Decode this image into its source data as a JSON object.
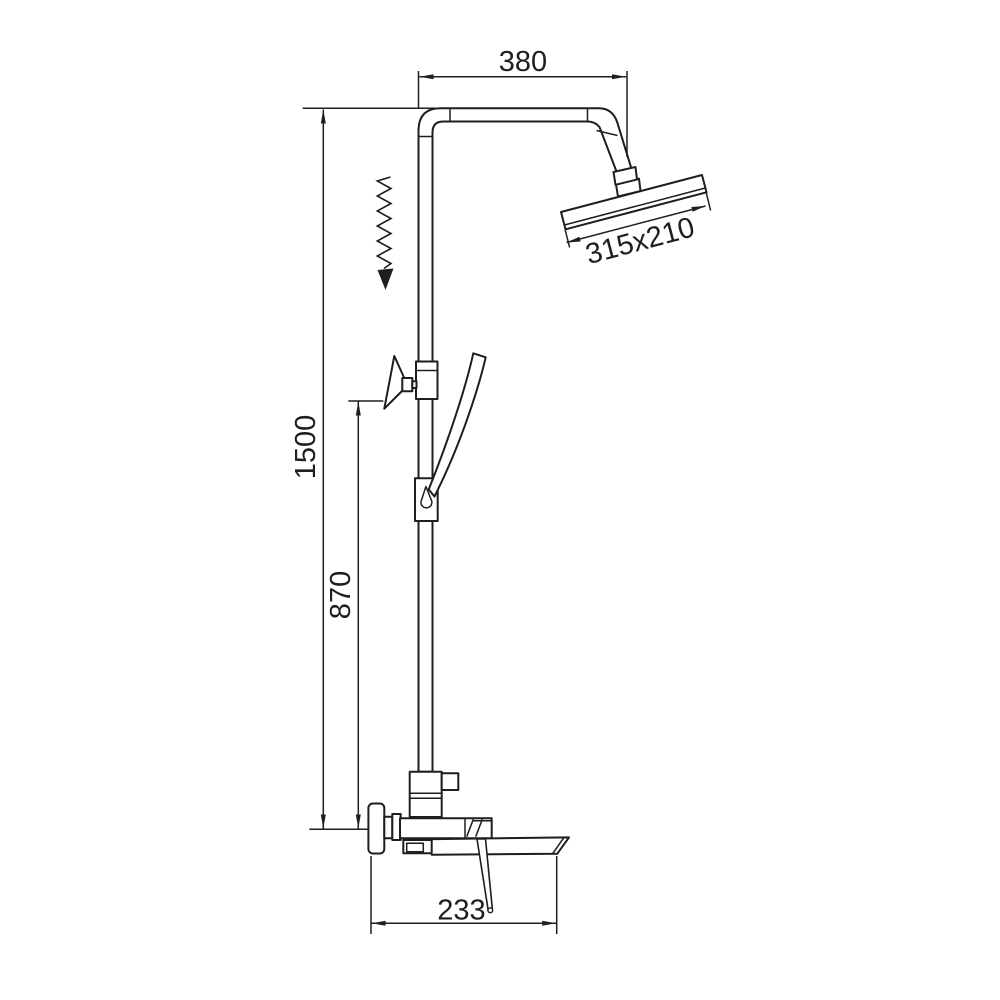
{
  "diagram": {
    "background_color": "#ffffff",
    "line_color": "#1e1e1e",
    "labels": {
      "top_width": "380",
      "head_size": "315x210",
      "overall_height": "1500",
      "holder_height": "870",
      "spout_length": "233"
    }
  }
}
